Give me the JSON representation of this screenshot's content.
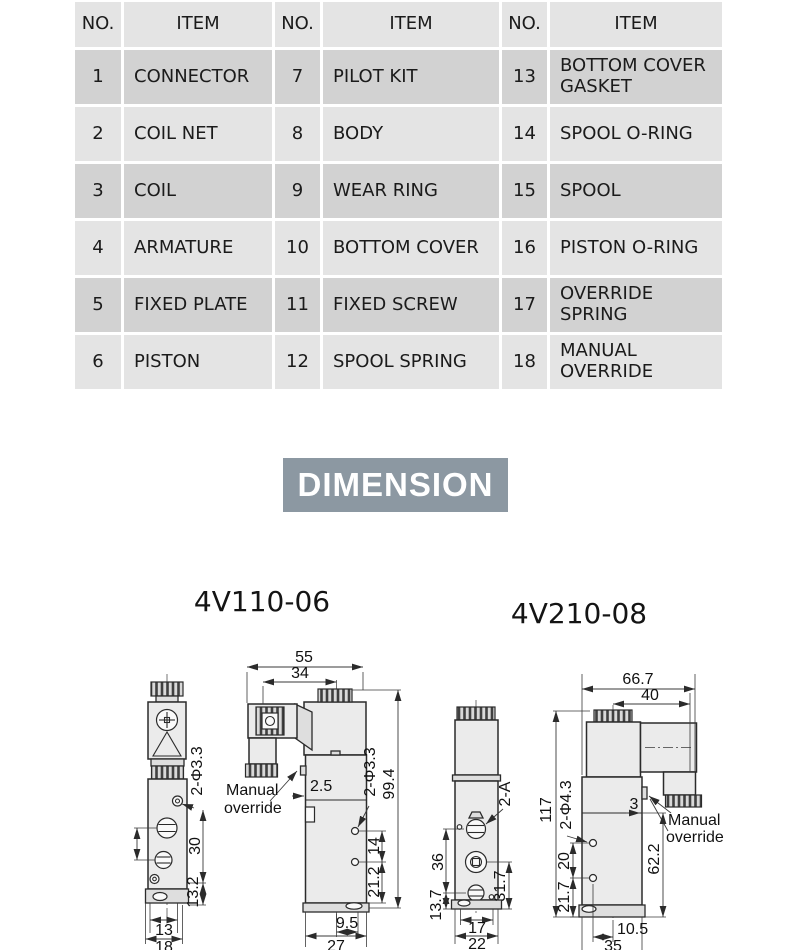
{
  "table": {
    "headers": [
      "NO.",
      "ITEM",
      "NO.",
      "ITEM",
      "NO.",
      "ITEM"
    ],
    "rows": [
      [
        "1",
        "CONNECTOR",
        "7",
        "PILOT KIT",
        "13",
        "BOTTOM COVER GASKET"
      ],
      [
        "2",
        "COIL NET",
        "8",
        "BODY",
        "14",
        "SPOOL O-RING"
      ],
      [
        "3",
        "COIL",
        "9",
        "WEAR RING",
        "15",
        "SPOOL"
      ],
      [
        "4",
        "ARMATURE",
        "10",
        "BOTTOM COVER",
        "16",
        "PISTON O-RING"
      ],
      [
        "5",
        "FIXED PLATE",
        "11",
        "FIXED SCREW",
        "17",
        "OVERRIDE SPRING"
      ],
      [
        "6",
        "PISTON",
        "12",
        "SPOOL SPRING",
        "18",
        "MANUAL OVERRIDE"
      ]
    ]
  },
  "section": {
    "title": "DIMENSION",
    "banner_color": "#8c98a2"
  },
  "drawings": {
    "v110": {
      "title": "4V110-06",
      "front": {
        "holes": "2-Φ3.3",
        "d30": "30",
        "d13_2": "13.2",
        "d13": "13",
        "d18": "18"
      },
      "side": {
        "d55": "55",
        "d34": "34",
        "mo": [
          "Manual",
          "override"
        ],
        "d2_5": "2.5",
        "holes": "2-Φ3.3",
        "d99_4": "99.4",
        "d14": "14",
        "d21_2": "21.2",
        "d9_5": "9.5",
        "d27": "27"
      }
    },
    "v210": {
      "title": "4V210-08",
      "front": {
        "port": "2-A",
        "d36": "36",
        "d13_7": "13.7",
        "d31_7": "31.7",
        "d17": "17",
        "d22": "22"
      },
      "side": {
        "d66_7": "66.7",
        "d40": "40",
        "d117": "117",
        "holes": "2-Φ4.3",
        "d3": "3",
        "mo": [
          "Manual",
          "override"
        ],
        "d62_2": "62.2",
        "d20": "20",
        "d21_7": "21.7",
        "d10_5": "10.5",
        "d35": "35"
      }
    }
  }
}
